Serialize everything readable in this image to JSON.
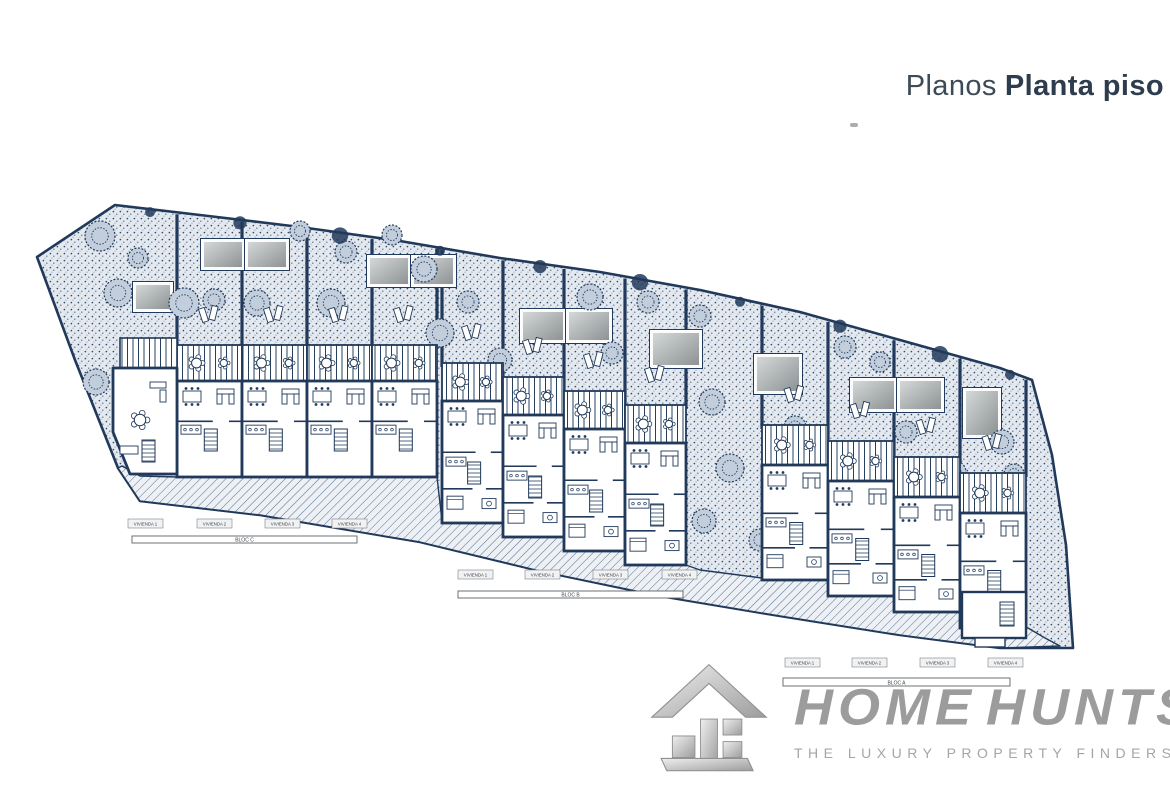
{
  "title": {
    "prefix": "Planos",
    "emphasis": "Planta piso"
  },
  "logo": {
    "icon": "house-3d-icon",
    "word1": "HOME",
    "word2": "HUNTS",
    "tagline": "THE LUXURY PROPERTY FINDERS"
  },
  "plan": {
    "ink": "#21395a",
    "site_outline": [
      [
        115,
        205
      ],
      [
        200,
        215
      ],
      [
        300,
        227
      ],
      [
        400,
        241
      ],
      [
        500,
        258
      ],
      [
        600,
        272
      ],
      [
        700,
        290
      ],
      [
        800,
        312
      ],
      [
        900,
        340
      ],
      [
        1000,
        368
      ],
      [
        1032,
        380
      ],
      [
        1052,
        455
      ],
      [
        1066,
        545
      ],
      [
        1073,
        648
      ],
      [
        1000,
        648
      ],
      [
        900,
        635
      ],
      [
        780,
        616
      ],
      [
        660,
        596
      ],
      [
        540,
        571
      ],
      [
        420,
        542
      ],
      [
        260,
        515
      ],
      [
        140,
        501
      ],
      [
        118,
        468
      ],
      [
        75,
        360
      ],
      [
        37,
        257
      ]
    ],
    "top_edge": [
      [
        115,
        205
      ],
      [
        200,
        215
      ],
      [
        300,
        227
      ],
      [
        400,
        241
      ],
      [
        500,
        258
      ],
      [
        600,
        272
      ],
      [
        700,
        290
      ],
      [
        800,
        312
      ],
      [
        900,
        340
      ],
      [
        1000,
        368
      ],
      [
        1032,
        380
      ]
    ],
    "street_band": [
      [
        122,
        466
      ],
      [
        140,
        476
      ],
      [
        177,
        477
      ],
      [
        437,
        477
      ],
      [
        442,
        521
      ],
      [
        503,
        523
      ],
      [
        503,
        537
      ],
      [
        564,
        537
      ],
      [
        564,
        551
      ],
      [
        625,
        551
      ],
      [
        625,
        565
      ],
      [
        686,
        565
      ],
      [
        700,
        570
      ],
      [
        762,
        578
      ],
      [
        828,
        580
      ],
      [
        828,
        596
      ],
      [
        894,
        596
      ],
      [
        894,
        611
      ],
      [
        960,
        611
      ],
      [
        960,
        628
      ],
      [
        1028,
        628
      ],
      [
        1045,
        638
      ],
      [
        1060,
        646
      ],
      [
        1000,
        648
      ],
      [
        900,
        635
      ],
      [
        780,
        616
      ],
      [
        660,
        596
      ],
      [
        540,
        571
      ],
      [
        420,
        542
      ],
      [
        260,
        515
      ],
      [
        140,
        501
      ],
      [
        118,
        468
      ]
    ],
    "blocks": [
      {
        "name": "BLOC C",
        "x": 177,
        "unit_w": 65,
        "units": 4,
        "terrace_y": 345,
        "step_y": 0,
        "terrace_h": 36,
        "interior_h": 96
      },
      {
        "name": "BLOC B",
        "x": 442,
        "unit_w": 61,
        "units": 4,
        "terrace_y": 363,
        "step_y": 14,
        "terrace_h": 38,
        "interior_h": 122
      },
      {
        "name": "BLOC A",
        "x": 762,
        "unit_w": 66,
        "units": 4,
        "terrace_y": 425,
        "step_y": 16,
        "terrace_h": 40,
        "interior_h": 115
      }
    ],
    "end_unit": [
      [
        113,
        368
      ],
      [
        177,
        368
      ],
      [
        177,
        474
      ],
      [
        130,
        474
      ],
      [
        113,
        432
      ]
    ],
    "end_unit_terrace": [
      120,
      338,
      57,
      30
    ],
    "annex": {
      "room": [
        962,
        592,
        64,
        46
      ],
      "stairs": [
        1000,
        602,
        14,
        24
      ],
      "step": [
        975,
        638,
        30,
        9
      ]
    },
    "pools": [
      [
        203,
        241,
        40,
        27
      ],
      [
        247,
        241,
        40,
        27
      ],
      [
        135,
        284,
        36,
        26
      ],
      [
        369,
        257,
        40,
        28
      ],
      [
        413,
        257,
        41,
        28
      ],
      [
        522,
        311,
        42,
        30
      ],
      [
        568,
        311,
        42,
        30
      ],
      [
        652,
        332,
        48,
        34
      ],
      [
        756,
        356,
        44,
        36
      ],
      [
        852,
        380,
        43,
        30
      ],
      [
        899,
        380,
        43,
        30
      ],
      [
        965,
        390,
        34,
        46
      ]
    ],
    "trees": [
      [
        100,
        236,
        15
      ],
      [
        138,
        258,
        10
      ],
      [
        118,
        293,
        14
      ],
      [
        184,
        303,
        15
      ],
      [
        96,
        382,
        13
      ],
      [
        163,
        437,
        14
      ],
      [
        214,
        300,
        11
      ],
      [
        257,
        303,
        13
      ],
      [
        331,
        303,
        14
      ],
      [
        346,
        252,
        11
      ],
      [
        424,
        269,
        13
      ],
      [
        440,
        333,
        14
      ],
      [
        300,
        231,
        10
      ],
      [
        392,
        235,
        10
      ],
      [
        468,
        302,
        11
      ],
      [
        500,
        360,
        12
      ],
      [
        590,
        297,
        13
      ],
      [
        612,
        353,
        11
      ],
      [
        648,
        302,
        11
      ],
      [
        700,
        316,
        11
      ],
      [
        712,
        402,
        13
      ],
      [
        730,
        468,
        14
      ],
      [
        704,
        521,
        12
      ],
      [
        795,
        427,
        11
      ],
      [
        845,
        347,
        11
      ],
      [
        880,
        362,
        10
      ],
      [
        906,
        432,
        11
      ],
      [
        955,
        472,
        11
      ],
      [
        1002,
        442,
        12
      ],
      [
        760,
        540,
        11
      ],
      [
        1014,
        474,
        10
      ]
    ],
    "top_bushes_x": [
      150,
      240,
      340,
      440,
      540,
      640,
      740,
      840,
      940,
      1010
    ],
    "legends": [
      {
        "block_label": "BLOC C",
        "bar": [
          132,
          536,
          225,
          7
        ],
        "tag_y": 519,
        "tags_x": [
          128,
          197,
          265,
          332
        ],
        "tags": [
          "VIVIENDA 1",
          "VIVIENDA 2",
          "VIVIENDA 3",
          "VIVIENDA 4"
        ]
      },
      {
        "block_label": "BLOC B",
        "bar": [
          458,
          591,
          225,
          7
        ],
        "tag_y": 570,
        "tags_x": [
          458,
          525,
          593,
          662
        ],
        "tags": [
          "VIVIENDA 1",
          "VIVIENDA 2",
          "VIVIENDA 3",
          "VIVIENDA 4"
        ]
      },
      {
        "block_label": "BLOC A",
        "bar": [
          783,
          678,
          227,
          8
        ],
        "tag_y": 658,
        "tags_x": [
          785,
          852,
          920,
          988
        ],
        "tags": [
          "VIVIENDA 1",
          "VIVIENDA 2",
          "VIVIENDA 3",
          "VIVIENDA 4"
        ]
      }
    ]
  }
}
